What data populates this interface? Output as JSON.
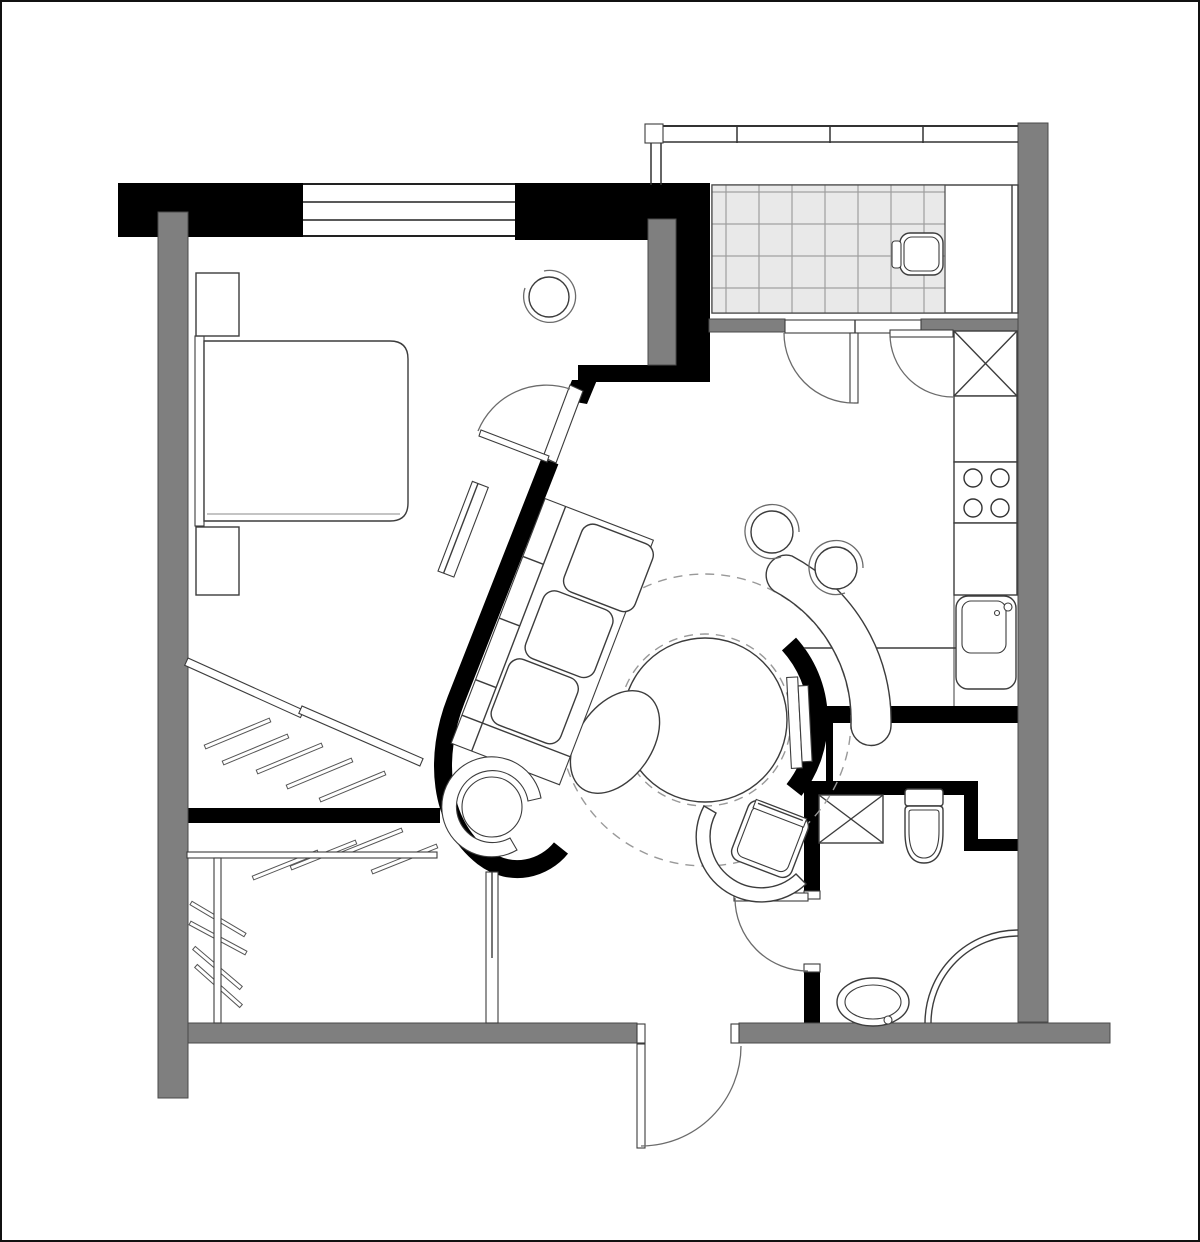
{
  "meta": {
    "kind": "architectural-floor-plan",
    "canvas_w": 1200,
    "canvas_h": 1242,
    "visible_text": "none"
  },
  "palette": {
    "paper": "#ffffff",
    "ink": "#000000",
    "gray": "#7f7f7f",
    "grayEdge": "#4a4a4a",
    "line": "#3c3c3c",
    "lineLight": "#6b6b6b",
    "dash": "#999999",
    "tileFill": "#e9e9e9",
    "tileGrid": "#9e9e9e",
    "border": "#111111"
  },
  "legend": {
    "zones": [
      "bedroom",
      "living-area",
      "kitchen",
      "bathroom",
      "balcony",
      "entrance-hall",
      "walk-in-closet"
    ],
    "fixtures": [
      "bed",
      "nightstand",
      "window-stool",
      "sofa-shelf-unit",
      "wall-shelf",
      "swivel-chair",
      "round-table",
      "chaise-ellipse",
      "curved-sofa",
      "pouf",
      "armchair-with-tablet",
      "tv-panel",
      "shaft-box",
      "stove",
      "sink",
      "toilet",
      "washer-box",
      "corner-shower",
      "oval-basin",
      "balcony-chair",
      "clothes-rail",
      "hanger-hatch"
    ]
  },
  "window": {
    "x1": 303,
    "x2": 515,
    "line_ys": [
      184,
      202,
      220,
      236
    ]
  },
  "railing": {
    "x1": 645,
    "x2": 1018,
    "y_top": 126,
    "y_bot": 142,
    "tick_xs": [
      737,
      830,
      923
    ]
  },
  "balcony_tiles": {
    "x": 712,
    "y": 185,
    "w": 233,
    "h": 128,
    "tile_w": 33,
    "tile_h": 32
  },
  "clearance_circles": [
    {
      "cx": 705,
      "cy": 720,
      "r": 86
    },
    {
      "cx": 705,
      "cy": 720,
      "r": 146
    }
  ],
  "stove_burners": {
    "r": 9,
    "centers": [
      [
        973,
        478
      ],
      [
        1000,
        478
      ],
      [
        973,
        508
      ],
      [
        1000,
        508
      ]
    ]
  },
  "hanger_hatch": {
    "strokes": [
      [
        205,
        747,
        270,
        720
      ],
      [
        223,
        763,
        288,
        736
      ],
      [
        257,
        772,
        322,
        745
      ],
      [
        287,
        787,
        352,
        760
      ],
      [
        320,
        800,
        385,
        773
      ],
      [
        253,
        878,
        318,
        852
      ],
      [
        291,
        868,
        356,
        842
      ],
      [
        337,
        856,
        402,
        830
      ],
      [
        372,
        872,
        437,
        846
      ],
      [
        191,
        903,
        245,
        935
      ],
      [
        190,
        923,
        246,
        953
      ],
      [
        194,
        948,
        241,
        988
      ],
      [
        196,
        966,
        241,
        1006
      ]
    ]
  }
}
